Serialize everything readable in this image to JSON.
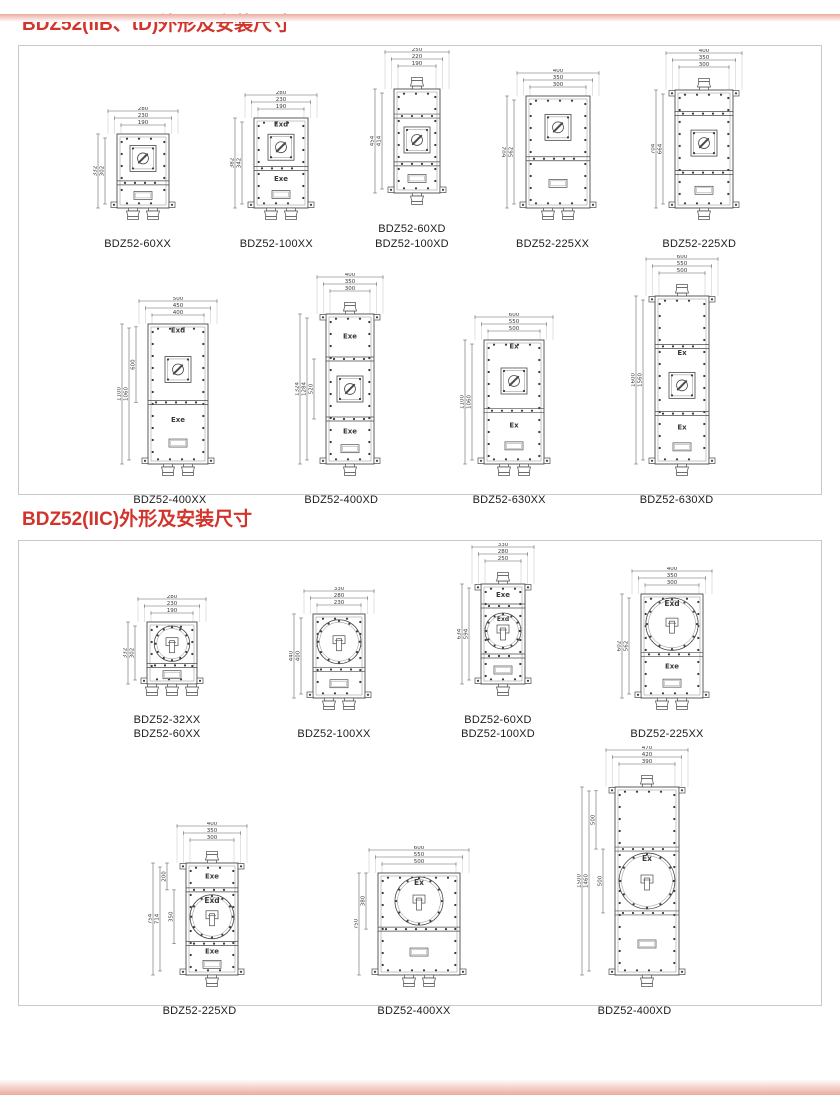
{
  "colors": {
    "title_red": "#d2342b",
    "line": "#4a4a4a",
    "panel_border": "#c9c9c9",
    "edge_pink": "#ecab9f"
  },
  "sections": [
    {
      "title": "BDZ52(IIB、tD)外形及安装尺寸",
      "rows": [
        {
          "drawings": [
            {
              "models": [
                "BDZ52-60XX"
              ],
              "top_dims": [
                "280",
                "230",
                "190"
              ],
              "side_dims": [
                "332",
                "302"
              ],
              "inner_dims": [],
              "body": {
                "w": 52,
                "h": 74
              },
              "parts": [
                {
                  "hf": 0.66,
                  "features": [
                    "switch"
                  ]
                },
                {
                  "hf": 0.34,
                  "features": [
                    "window"
                  ]
                }
              ],
              "glands_top": 0,
              "glands_bottom": 2,
              "feet": true,
              "top_tabs": false
            },
            {
              "models": [
                "BDZ52-100XX"
              ],
              "top_dims": [
                "280",
                "230",
                "190"
              ],
              "side_dims": [
                "382",
                "342"
              ],
              "inner_dims": [],
              "body": {
                "w": 54,
                "h": 90
              },
              "parts": [
                {
                  "hf": 0.56,
                  "label": "Exd",
                  "features": [
                    "switch"
                  ]
                },
                {
                  "hf": 0.44,
                  "label": "Exe",
                  "features": [
                    "window"
                  ]
                }
              ],
              "glands_top": 0,
              "glands_bottom": 2,
              "feet": true,
              "top_tabs": false
            },
            {
              "models": [
                "BDZ52-60XD",
                "BDZ52-100XD"
              ],
              "top_dims": [
                "250",
                "220",
                "190"
              ],
              "side_dims": [
                "454",
                "414"
              ],
              "inner_dims": [],
              "body": {
                "w": 46,
                "h": 104
              },
              "parts": [
                {
                  "hf": 0.26,
                  "features": []
                },
                {
                  "hf": 0.46,
                  "features": [
                    "switch"
                  ]
                },
                {
                  "hf": 0.28,
                  "features": [
                    "window"
                  ]
                }
              ],
              "glands_top": 1,
              "glands_bottom": 1,
              "feet": true,
              "top_tabs": false
            },
            {
              "models": [
                "BDZ52-225XX"
              ],
              "top_dims": [
                "400",
                "350",
                "300"
              ],
              "side_dims": [
                "602",
                "562"
              ],
              "inner_dims": [],
              "body": {
                "w": 64,
                "h": 112
              },
              "parts": [
                {
                  "hf": 0.56,
                  "features": [
                    "switch"
                  ]
                },
                {
                  "hf": 0.44,
                  "features": [
                    "window"
                  ]
                }
              ],
              "glands_top": 0,
              "glands_bottom": 2,
              "feet": true,
              "top_tabs": false
            },
            {
              "models": [
                "BDZ52-225XD"
              ],
              "top_dims": [
                "400",
                "350",
                "300"
              ],
              "side_dims": [
                "704",
                "664"
              ],
              "inner_dims": [],
              "body": {
                "w": 58,
                "h": 118
              },
              "parts": [
                {
                  "hf": 0.2,
                  "features": []
                },
                {
                  "hf": 0.5,
                  "features": [
                    "switch"
                  ]
                },
                {
                  "hf": 0.3,
                  "features": [
                    "window"
                  ]
                }
              ],
              "glands_top": 1,
              "glands_bottom": 1,
              "feet": true,
              "top_tabs": true
            }
          ]
        },
        {
          "drawings": [
            {
              "models": [
                "BDZ52-400XX"
              ],
              "top_dims": [
                "500",
                "450",
                "400"
              ],
              "side_dims": [
                "1100",
                "1060"
              ],
              "inner_dims": [
                {
                  "v": "600",
                  "a": 0.02,
                  "b": 0.56
                }
              ],
              "body": {
                "w": 60,
                "h": 140
              },
              "parts": [
                {
                  "hf": 0.56,
                  "label": "Exd",
                  "features": [
                    "switch"
                  ]
                },
                {
                  "hf": 0.44,
                  "label": "Exe",
                  "features": [
                    "window"
                  ]
                }
              ],
              "glands_top": 0,
              "glands_bottom": 2,
              "feet": true,
              "top_tabs": false
            },
            {
              "models": [
                "BDZ52-400XD"
              ],
              "top_dims": [
                "400",
                "350",
                "300"
              ],
              "side_dims": [
                "1324",
                "1284"
              ],
              "inner_dims": [
                {
                  "v": "520",
                  "a": 0.3,
                  "b": 0.7
                }
              ],
              "body": {
                "w": 48,
                "h": 150
              },
              "parts": [
                {
                  "hf": 0.3,
                  "label": "Exe",
                  "features": []
                },
                {
                  "hf": 0.4,
                  "features": [
                    "switch"
                  ]
                },
                {
                  "hf": 0.3,
                  "label": "Exe",
                  "features": [
                    "window"
                  ]
                }
              ],
              "glands_top": 1,
              "glands_bottom": 1,
              "feet": true,
              "top_tabs": true
            },
            {
              "models": [
                "BDZ52-630XX"
              ],
              "top_dims": [
                "600",
                "550",
                "500"
              ],
              "side_dims": [
                "1100",
                "1060"
              ],
              "inner_dims": [],
              "body": {
                "w": 60,
                "h": 124
              },
              "parts": [
                {
                  "hf": 0.57,
                  "label": "Ex",
                  "features": [
                    "switch"
                  ]
                },
                {
                  "hf": 0.43,
                  "label": "Ex",
                  "features": [
                    "window"
                  ]
                }
              ],
              "glands_top": 0,
              "glands_bottom": 2,
              "feet": true,
              "top_tabs": false
            },
            {
              "models": [
                "BDZ52-630XD"
              ],
              "top_dims": [
                "600",
                "550",
                "500"
              ],
              "side_dims": [
                "1600",
                "1560"
              ],
              "inner_dims": [],
              "body": {
                "w": 54,
                "h": 168
              },
              "parts": [
                {
                  "hf": 0.3,
                  "features": []
                },
                {
                  "hf": 0.4,
                  "label": "Ex",
                  "features": [
                    "switch"
                  ]
                },
                {
                  "hf": 0.3,
                  "label": "Ex",
                  "features": [
                    "window"
                  ]
                }
              ],
              "glands_top": 1,
              "glands_bottom": 1,
              "feet": true,
              "top_tabs": true
            }
          ]
        }
      ]
    },
    {
      "title": "BDZ52(IIC)外形及安装尺寸",
      "rows": [
        {
          "drawings": [
            {
              "models": [
                "BDZ52-32XX",
                "BDZ52-60XX"
              ],
              "top_dims": [
                "280",
                "230",
                "190"
              ],
              "side_dims": [
                "332",
                "302"
              ],
              "inner_dims": [],
              "body": {
                "w": 50,
                "h": 62
              },
              "parts": [
                {
                  "hf": 0.7,
                  "features": [
                    "circle_switch"
                  ]
                },
                {
                  "hf": 0.3,
                  "features": [
                    "window"
                  ]
                }
              ],
              "glands_top": 0,
              "glands_bottom": 3,
              "feet": true,
              "top_tabs": false
            },
            {
              "models": [
                "BDZ52-100XX"
              ],
              "top_dims": [
                "330",
                "280",
                "230"
              ],
              "side_dims": [
                "440",
                "400"
              ],
              "inner_dims": [],
              "body": {
                "w": 52,
                "h": 84
              },
              "parts": [
                {
                  "hf": 0.66,
                  "features": [
                    "circle_switch"
                  ]
                },
                {
                  "hf": 0.34,
                  "features": [
                    "window"
                  ]
                }
              ],
              "glands_top": 0,
              "glands_bottom": 2,
              "feet": true,
              "top_tabs": false
            },
            {
              "models": [
                "BDZ52-60XD",
                "BDZ52-100XD"
              ],
              "top_dims": [
                "330",
                "280",
                "250"
              ],
              "side_dims": [
                "634",
                "594"
              ],
              "inner_dims": [],
              "body": {
                "w": 44,
                "h": 100
              },
              "parts": [
                {
                  "hf": 0.22,
                  "label": "Exe",
                  "features": []
                },
                {
                  "hf": 0.5,
                  "label": "Exd",
                  "features": [
                    "circle_switch"
                  ]
                },
                {
                  "hf": 0.28,
                  "features": [
                    "window"
                  ]
                }
              ],
              "glands_top": 1,
              "glands_bottom": 1,
              "feet": true,
              "top_tabs": true
            },
            {
              "models": [
                "BDZ52-225XX"
              ],
              "top_dims": [
                "400",
                "350",
                "300"
              ],
              "side_dims": [
                "602",
                "562"
              ],
              "inner_dims": [],
              "body": {
                "w": 62,
                "h": 104
              },
              "parts": [
                {
                  "hf": 0.58,
                  "label": "Exd",
                  "features": [
                    "circle_switch"
                  ]
                },
                {
                  "hf": 0.42,
                  "label": "Exe",
                  "features": [
                    "window"
                  ]
                }
              ],
              "glands_top": 0,
              "glands_bottom": 2,
              "feet": true,
              "top_tabs": false
            }
          ]
        },
        {
          "drawings": [
            {
              "models": [
                "BDZ52-225XD"
              ],
              "top_dims": [
                "400",
                "350",
                "300"
              ],
              "side_dims": [
                "754",
                "714"
              ],
              "inner_dims": [
                {
                  "v": "200",
                  "a": 0.0,
                  "b": 0.24
                },
                {
                  "v": "350",
                  "a": 0.24,
                  "b": 0.72
                }
              ],
              "body": {
                "w": 52,
                "h": 112
              },
              "parts": [
                {
                  "hf": 0.24,
                  "label": "Exe",
                  "features": []
                },
                {
                  "hf": 0.48,
                  "label": "Exd",
                  "features": [
                    "circle_switch"
                  ]
                },
                {
                  "hf": 0.28,
                  "label": "Exe",
                  "features": [
                    "window"
                  ]
                }
              ],
              "glands_top": 1,
              "glands_bottom": 1,
              "feet": true,
              "top_tabs": true
            },
            {
              "models": [
                "BDZ52-400XX"
              ],
              "top_dims": [
                "600",
                "550",
                "500"
              ],
              "side_dims": [
                "750"
              ],
              "inner_dims": [
                {
                  "v": "380",
                  "a": 0.0,
                  "b": 0.55
                }
              ],
              "body": {
                "w": 82,
                "h": 102
              },
              "parts": [
                {
                  "hf": 0.55,
                  "label": "Ex",
                  "features": [
                    "circle_switch"
                  ]
                },
                {
                  "hf": 0.45,
                  "features": [
                    "window"
                  ]
                }
              ],
              "glands_top": 0,
              "glands_bottom": 2,
              "feet": true,
              "top_tabs": false
            },
            {
              "models": [
                "BDZ52-400XD"
              ],
              "top_dims": [
                "470",
                "420",
                "390"
              ],
              "side_dims": [
                "1500",
                "1460"
              ],
              "inner_dims": [
                {
                  "v": "500",
                  "a": 0.02,
                  "b": 0.33
                },
                {
                  "v": "500",
                  "a": 0.33,
                  "b": 0.67
                }
              ],
              "body": {
                "w": 64,
                "h": 188
              },
              "parts": [
                {
                  "hf": 0.33,
                  "features": []
                },
                {
                  "hf": 0.34,
                  "label": "Ex",
                  "features": [
                    "circle_switch"
                  ]
                },
                {
                  "hf": 0.33,
                  "features": [
                    "window"
                  ]
                }
              ],
              "glands_top": 1,
              "glands_bottom": 1,
              "feet": true,
              "top_tabs": true
            }
          ]
        }
      ]
    }
  ]
}
